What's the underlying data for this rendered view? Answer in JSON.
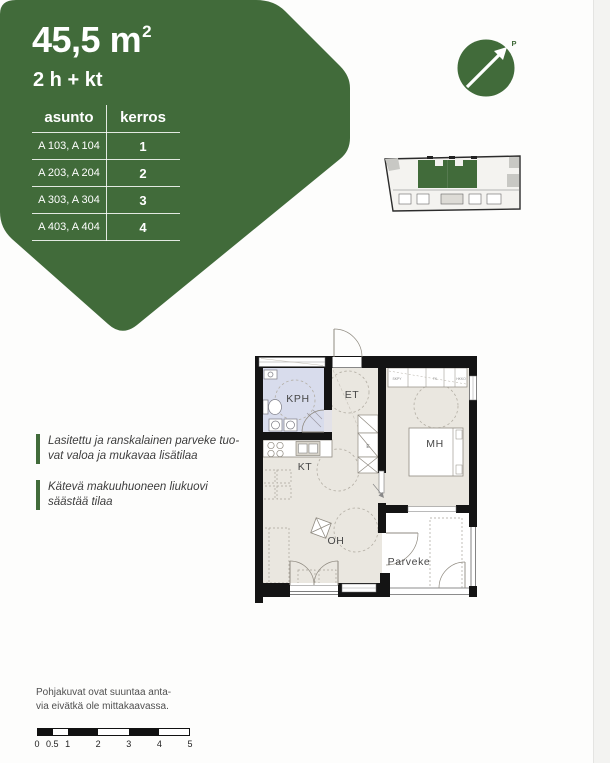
{
  "colors": {
    "green": "#416b3a",
    "floor_beige": "#eae7e0",
    "bath_lavender": "#d8dcec",
    "wall": "#141414"
  },
  "banner": {
    "area": "45,5 m",
    "area_sup": "2",
    "type": "2 h + kt",
    "table": {
      "col1": "asunto",
      "col2": "kerros",
      "rows": [
        {
          "apts": "A 103, A 104",
          "floor": "1"
        },
        {
          "apts": "A 203, A 204",
          "floor": "2"
        },
        {
          "apts": "A 303, A 304",
          "floor": "3"
        },
        {
          "apts": "A 403, A 404",
          "floor": "4"
        }
      ]
    }
  },
  "compass": {
    "north": "P"
  },
  "floorplan": {
    "rooms": {
      "kph": "KPH",
      "et": "ET",
      "mh": "MH",
      "kt": "KT",
      "oh": "OH",
      "parveke": "Parveke"
    },
    "closet_small": [
      "SKPY",
      "TK",
      "HKKO"
    ],
    "tech": "E"
  },
  "notes": [
    {
      "line1": "Lasitettu ja ranskalainen parveke tuo-",
      "line2": "vat valoa ja mukavaa lisätilaa"
    },
    {
      "line1": "Kätevä makuuhuoneen liukuovi",
      "line2": "säästää tilaa"
    }
  ],
  "disclaimer": {
    "line1": "Pohjakuvat ovat suuntaa anta-",
    "line2": "via eivätkä ole mittakaavassa."
  },
  "scalebar": {
    "labels": [
      "0",
      "0.5",
      "1",
      "2",
      "3",
      "4",
      "5"
    ]
  }
}
